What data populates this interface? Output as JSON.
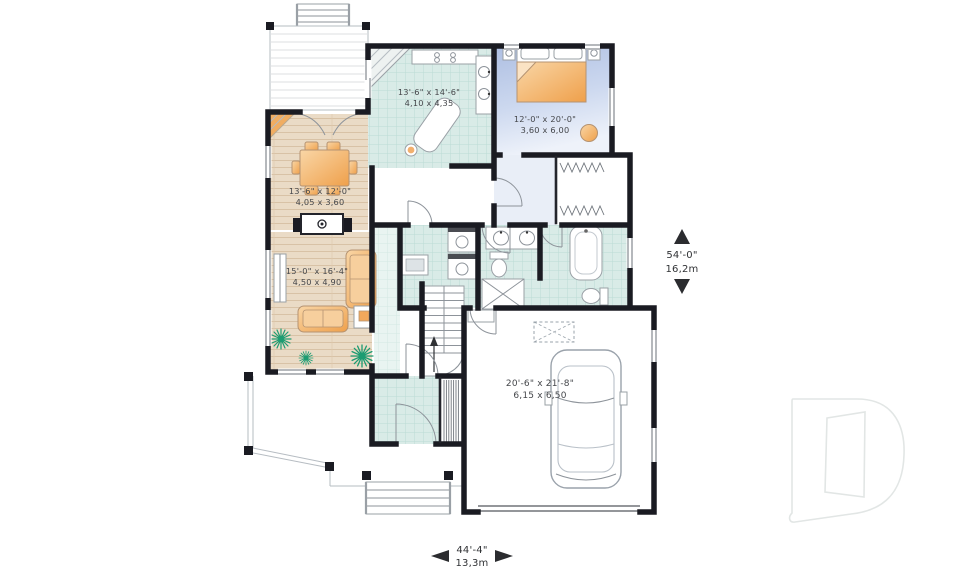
{
  "canvas": {
    "width": 960,
    "height": 569,
    "background": "#ffffff"
  },
  "rooms": {
    "kitchen": {
      "label_imperial": "13'-6\" x 14'-6\"",
      "label_metric": "4,10 x 4,35"
    },
    "bedroom": {
      "label_imperial": "12'-0\" x 20'-0\"",
      "label_metric": "3,60 x 6,00"
    },
    "dining": {
      "label_imperial": "13'-6\" x 12'-0\"",
      "label_metric": "4,05 x 3,60"
    },
    "living": {
      "label_imperial": "15'-0\" x 16'-4\"",
      "label_metric": "4,50 x 4,90"
    },
    "garage": {
      "label_imperial": "20'-6\" x 21'-8\"",
      "label_metric": "6,15 x 6,50"
    }
  },
  "dimensions": {
    "overall_depth": {
      "imperial": "54'-0\"",
      "metric": "16,2m"
    },
    "overall_width": {
      "imperial": "44'-4\"",
      "metric": "13,3m"
    }
  },
  "logo": {
    "letter": "D",
    "style": "outline-watermark",
    "color": "#e2e6e5"
  },
  "colors": {
    "wall": "#1a1b22",
    "tile_floor": "#d9ebe7",
    "tile_grid": "#bcdbd4",
    "wood_floor": "#eadbc6",
    "wood_grain": "#d8c2a6",
    "carpet_blue": "#aebfe2",
    "furniture_orange": "#efa04b",
    "plant_green": "#1d9c72",
    "dimension_text": "#303235"
  }
}
